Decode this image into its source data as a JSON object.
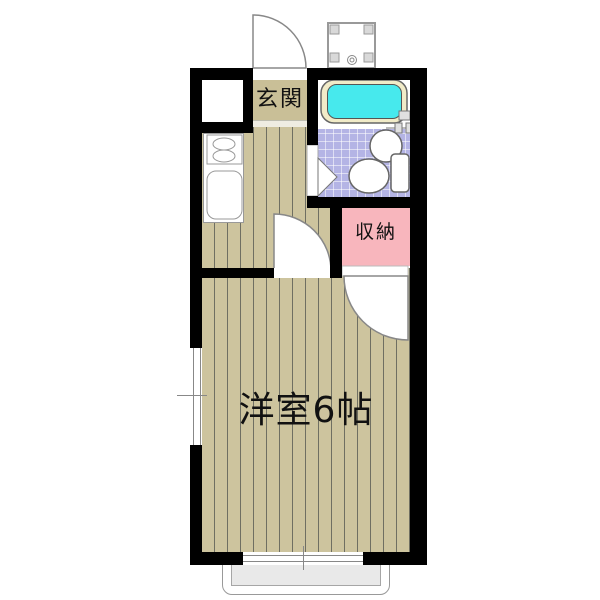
{
  "floorplan": {
    "labels": {
      "entrance": "玄関",
      "storage": "収納",
      "main_room": "洋室6帖"
    },
    "rooms": [
      {
        "name": "entrance",
        "label": "玄関"
      },
      {
        "name": "storage-closet",
        "label": "収納"
      },
      {
        "name": "western-room",
        "label": "洋室6帖",
        "size_tatami": 6
      }
    ],
    "fixtures": [
      "bathtub",
      "wash-basin",
      "toilet",
      "washing-machine-pan",
      "shoe-cabinet",
      "stove",
      "kitchen-sink",
      "balcony",
      "entrance-door",
      "room-door",
      "closet-door",
      "bathroom-door",
      "window-left",
      "window-balcony"
    ],
    "colors": {
      "wall": "#000000",
      "floor_wood": "#cdc49e",
      "floor_stripe_line": "#6f6f62",
      "genkan_floor": "#c9bf97",
      "bath_tile": "#b4b4e5",
      "bathtub_rim": "#f1ebc8",
      "bathtub_water": "#47e9ed",
      "storage_fill": "#f8b6bd",
      "balcony_fill": "#e9e9e9",
      "fixture_outline": "#777777"
    }
  }
}
